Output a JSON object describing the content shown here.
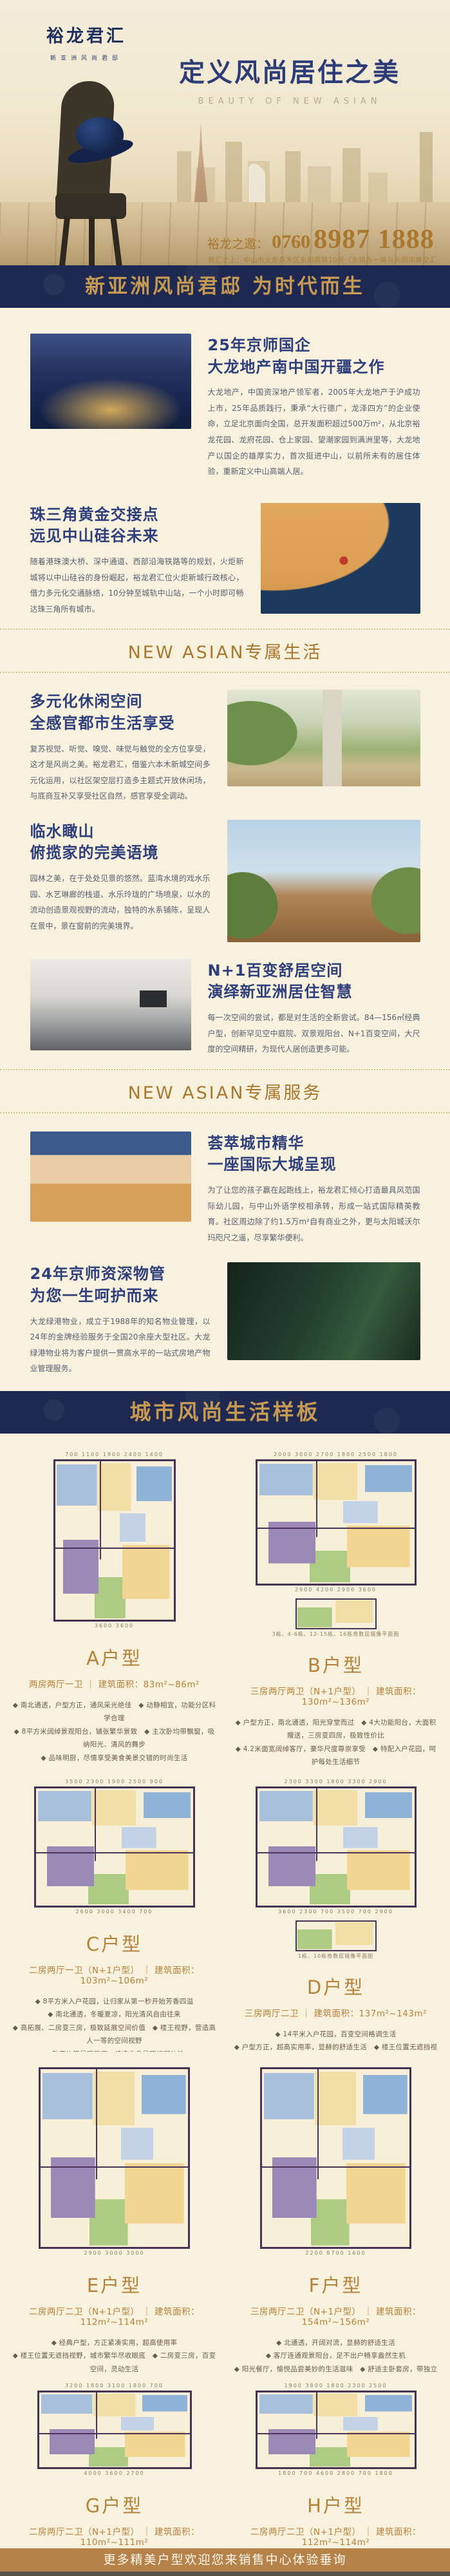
{
  "hero": {
    "logo": "裕龙君汇",
    "logo_sub": "新亚洲风尚君邸",
    "title": "定义风尚居住之美",
    "subtitle": "BEAUTY OF NEW ASIAN",
    "phone_label": "裕龙之邀：",
    "phone_prefix": "0760",
    "phone_number": "8987 1888",
    "address": "君汇之上：中山市火炬开发区东阳南路10号（东镇东一路与东阳南路交汇处）"
  },
  "banner_top": "新亚洲风尚君邸 为时代而生",
  "life_divider": "NEW ASIAN专属生活",
  "service_divider": "NEW ASIAN专属服务",
  "banner_plans": "城市风尚生活样板",
  "sections": [
    {
      "h1": "25年京师国企",
      "h2": "大龙地产南中国开疆之作",
      "body": "大龙地产，中国资深地产领军者，2005年大龙地产于沪成功上市，25年品质践行，秉承“大行德广，龙泽四方”的企业使命，立足北京面向全国，总开发面积超过500万m²，从北京裕龙花园、龙府花园、仓上家园、望潮家园到满洲里等，大龙地产以国企的雄厚实力，首次挺进中山，以前所未有的居住体验，重新定义中山高端人居。"
    },
    {
      "h1": "珠三角黄金交接点",
      "h2": "远见中山硅谷未来",
      "body": "随着港珠澳大桥、深中通道、西部沿海铁路等的规划，火炬新城将以中山硅谷的身份崛起，裕龙君汇位火炬新城行政核心，借力多元化交通脉络，10分钟至城轨中山站，一个小时即可畅达珠三角所有城市。"
    },
    {
      "h1": "多元化休闲空间",
      "h2": "全感官都市生活享受",
      "body": "复苏视觉、听觉、嗅觉、味觉与触觉的全方位享受，这才是风尚之美。裕龙君汇，借鉴六本木新城空间多元化运用，以社区架空层打造多主题式开放休闲场，与底商互补又享受社区自然，感官享受全调动。"
    },
    {
      "h1": "临水瞰山",
      "h2": "俯揽家的完美语境",
      "body": "园林之美，在于处处见景的悠然。蓝湾水境的戏水乐园、水艺琳廊的栈道、水乐玲珑的广场喷泉，以水的流动创造景观视野的流动，独特的水系铺陈，呈现人在景中，景在窗前的完美境界。"
    },
    {
      "h1": "N+1百变舒居空间",
      "h2": "演绎新亚洲居住智慧",
      "body": "每一次空间的尝试，都是对生活的全新尝试。84—156㎡经典户型，创新罕见空中庭院、双景观阳台、N+1百变空间，大尺度的空间精研，为现代人居创造更多可能。"
    },
    {
      "h1": "荟萃城市精华",
      "h2": "一座国际大城呈现",
      "body": "为了让您的孩子赢在起跑线上，裕龙君汇倾心打造最具风范国际幼儿园，与中山外语学校相承转，形成一站式国际精英教育。社区周边除了约1.5万m²自有商业之外，更与太阳城沃尔玛咫尺之遥，尽享繁华便利。"
    },
    {
      "h1": "24年京师资深物管",
      "h2": "为您一生呵护而来",
      "body": "大龙绿港物业，成立于1988年的知名物业管理，以24年的金牌经验服务于全国20余座大型社区。大龙绿港物业将为客户提供一贯高水平的一站式房地产物业管理服务。"
    }
  ],
  "plans": [
    {
      "name": "A户型",
      "spec": "两房两厅一卫 ｜ 建筑面积：83m²~86m²",
      "dims_top": "700  1100  1900  2400  1400",
      "dims_bottom": "3600    3600",
      "lines": [
        "◆ 南北通透，户型方正，通风采光绝佳　◆ 动静相宜，功能分区科学合理",
        "◆ 8平方米阔绰景观阳台，铺张繁华景致　◆ 主次卧均带飘窗，吸纳阳光、清风的舞步",
        "◆ 品味明厨，尽情享受美食美景交错的时尚生活"
      ]
    },
    {
      "name": "B户型",
      "spec": "三房两厅两卫（N+1户型） ｜ 建筑面积：130m²~136m²",
      "dims_top": "2000  3000  2700  1800  2500  1800",
      "dims_bottom": "2900  4200  2900  3600",
      "note": "3栋、4-6栋、12-15栋、16栋奇数层镜像平面图",
      "lines": [
        "◆ 户型方正，南北通透，阳光穿堂而过　◆ 4大功能阳台，大面积赠送，三房变四房，极致性价比",
        "◆ 4.2米面宽阔绰客厅，豪华尺度尊崇享受　◆ 特配入户花园，呵护每处生活细节",
        "◆ 卧室均带景观飘窗，营造非凡景观视野体验"
      ]
    },
    {
      "name": "C户型",
      "spec": "二房两厅一卫（N+1户型） ｜ 建筑面积：103m²~106m²",
      "dims_top": "3500  2300  1900  2500  900",
      "dims_bottom": "2600  3000  3400  700",
      "lines": [
        "◆ 8平方米入户花园，让归家从第一秒开始芳香四溢",
        "◆ 南北通透，冬暖夏凉，阳光清风自由往来",
        "◆ 高拓展、二房变三房，极致延展空间价值　◆ 楼王视野，营造高人一等的空间视野",
        "◆ 卧室均带景观飘窗，缔造非凡景观视野体验"
      ]
    },
    {
      "name": "D户型",
      "spec": "三房两厅二卫 ｜ 建筑面积：137m²~143m²",
      "dims_top": "2300  3300  1800  3300  2900",
      "dims_bottom": "3600  2300  700  3500  700  2900",
      "note": "1栋、10栋奇数层镜像平面图",
      "lines": [
        "◆ 14平米入户花园，百变空间格调生活",
        "◆ 户型方正，超高实用率，显赫的舒适生活　◆ 楼王位置无遮挡视野，城市繁华尽收眼底",
        "◆ 主卧带衣帽间、洗手间，营造休憩私密享受",
        "◆ 动静相宜，免噪音干扰，给予生活无限关怀"
      ]
    },
    {
      "name": "E户型",
      "spec": "二房两厅二卫（N+1户型） ｜ 建筑面积：112m²~114m²",
      "dims_top": "",
      "dims_bottom": "2900  3000  3000",
      "lines": [
        "◆ 经典户型，方正紧凑实用，超高使用率",
        "◆ 楼王位置无遮挡视野，城市繁华尽收眼底　◆ 二房变三房，百变空间，灵动生活",
        "◆ 动静相宜、干湿分区，尽显人性化细节设计",
        "◆ 观景阳台，休憩中饱览景观园林无限美景"
      ]
    },
    {
      "name": "F户型",
      "spec": "三房两厅二卫（N+1户型） ｜ 建筑面积：154m²~156m²",
      "dims_top": "",
      "dims_bottom": "2200  8700  1600",
      "lines": [
        "◆ 北通透，开阔对流，显赫的舒适生活",
        "◆ 客厅连通观景阳台，足不出户畅享盎然生机",
        "◆ 阳光餐厅，愉悦品尝美妙的生活滋味　◆ 舒适主卧套房，带独立卫生间、私密尊崇",
        "◆ 动静相宜，极致空间科学合理"
      ]
    },
    {
      "name": "G户型",
      "spec": "二房两厅二卫（N+1户型） ｜ 建筑面积：110m²~111m²",
      "dims_top": "3200  1800  3100  1800  700",
      "dims_bottom": "4000  3600  2700",
      "lines": [
        "◆ 舒适三房，户型方正紧凑实用　◆ 罕见双卫，营造休憩私密专属享受",
        "◆ 高拓展，二房变三房，极致延展空间价值",
        "◆ 阳光厨房带生活阳台，彰显完美居家品质　◆ 阔绰景观阳台，悦纳无限风光"
      ]
    },
    {
      "name": "H户型",
      "spec": "二房两厅二卫（N+1户型） ｜ 建筑面积：112m²~114m²",
      "dims_top": "1900  3800  1800  2300  2500",
      "dims_bottom": "1800  700  4600  2800  700  1800",
      "lines": [
        "◆ 明厨明卫，阳光洒满生活每个细节",
        "◆ 10平米景观大阳台，弥足珍贵的双景视角　◆ 内庭花园百变空间，容纳所有生活创想",
        "◆ 主次卧配备阳光飘窗，清风阳光在室内肆意延伸　◆ 动静分明，功能分区科学合理"
      ]
    }
  ],
  "footer": "更多精美户型欢迎您来销售中心体验垂询"
}
